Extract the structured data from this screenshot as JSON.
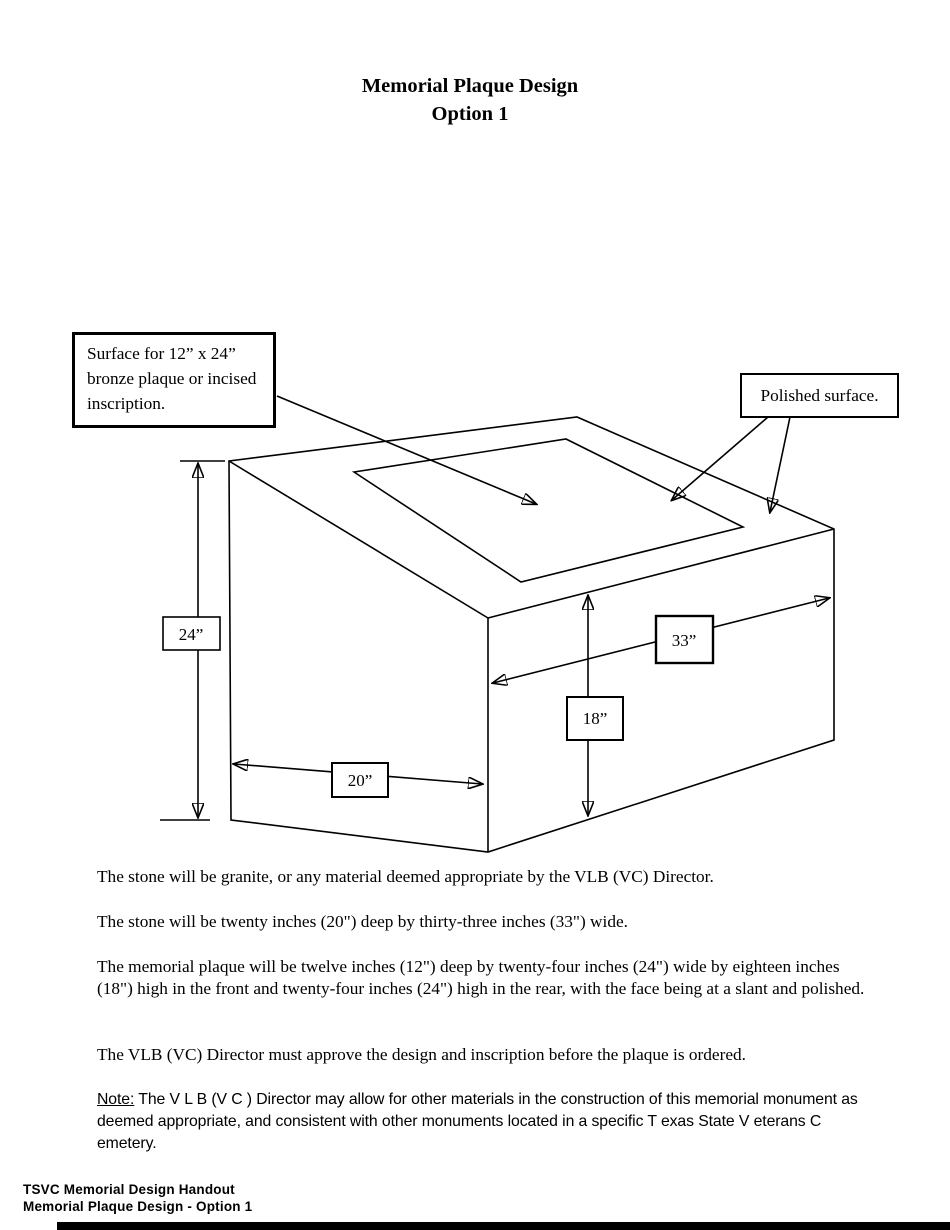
{
  "title": {
    "line1": "Memorial Plaque Design",
    "line2": "Option 1"
  },
  "diagram": {
    "callouts": {
      "plaque_surface": "Surface for 12” x 24” bronze plaque or incised inscription.",
      "polished_surface": "Polished surface."
    },
    "dimensions": {
      "rear_height": "24”",
      "width": "33”",
      "front_height": "18”",
      "depth": "20”"
    }
  },
  "paragraphs": [
    "The stone will be granite, or any material deemed appropriate by the VLB (VC) Director.",
    "The stone will be twenty inches (20\") deep by thirty-three inches (33\") wide.",
    "The memorial plaque will be twelve inches (12\") deep by twenty-four inches (24\") wide by eighteen inches (18\") high in the front and twenty-four inches (24\") high in the rear, with the face being at a slant and polished.",
    "The VLB (VC) Director must approve the design and inscription before the plaque is ordered."
  ],
  "note": {
    "label": "Note:",
    "rest": " The V L B (V C ) Director may allow for other materials in the construction of this memorial monument as deemed appropriate, and consistent with other monuments located in a specific T exas State V eterans C emetery."
  },
  "footer": {
    "line1": "TSVC Memorial Design Handout",
    "line2": "Memorial Plaque Design - Option 1"
  }
}
